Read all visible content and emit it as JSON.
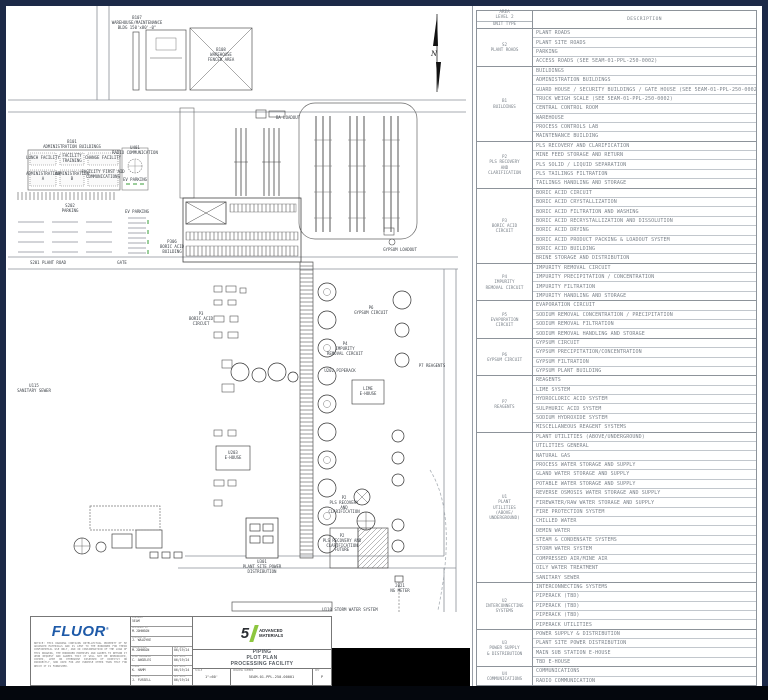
{
  "colors": {
    "frame_navy": "#1c2947",
    "fluor_blue": "#1e5aa8",
    "brand_green": "#8dc63f",
    "line_gray": "#666666"
  },
  "table": {
    "header": {
      "area": "AREA\nLEVEL 2",
      "unit_type": "UNIT TYPE",
      "description": "DESCRIPTION"
    },
    "groups": [
      {
        "code": "S2",
        "label_lines": [
          "S2",
          "PLANT ROADS"
        ],
        "rows": [
          "PLANT ROADS",
          "PLANT SITE ROADS",
          "PARKING",
          "ACCESS ROADS (SEE 5EAM-01-PPL-250-0002)"
        ]
      },
      {
        "code": "B1",
        "label_lines": [
          "B1",
          "BUILDINGS"
        ],
        "rows": [
          "BUILDINGS",
          "ADMINISTRATION BUILDINGS",
          "GUARD HOUSE / SECURITY BUILDINGS / GATE HOUSE (SEE 5EAM-01-PPL-250-0002)",
          "TRUCK WEIGH SCALE (SEE 5EAM-01-PPL-250-0002)",
          "CENTRAL CONTROL ROOM",
          "WAREHOUSE",
          "PROCESS CONTROLS LAB",
          "MAINTENANCE BUILDING"
        ]
      },
      {
        "code": "P2",
        "label_lines": [
          "P2",
          "PLS RECOVERY",
          "AND",
          "CLARIFICATION"
        ],
        "rows": [
          "PLS RECOVERY AND CLARIFICATION",
          "MINE FEED STORAGE AND RETURN",
          "PLS SOLID / LIQUID SEPARATION",
          "PLS TAILINGS FILTRATION",
          "TAILINGS HANDLING AND STORAGE"
        ]
      },
      {
        "code": "P3",
        "label_lines": [
          "P3",
          "BORIC ACID",
          "CIRCUIT"
        ],
        "rows": [
          "BORIC ACID CIRCUIT",
          "BORIC ACID CRYSTALLIZATION",
          "BORIC ACID FILTRATION AND WASHING",
          "BORIC ACID RECRYSTALLIZATION AND DISSOLUTION",
          "BORIC ACID DRYING",
          "BORIC ACID PRODUCT PACKING & LOADOUT SYSTEM",
          "BORIC ACID BUILDING",
          "BRINE STORAGE AND DISTRIBUTION"
        ]
      },
      {
        "code": "P4",
        "label_lines": [
          "P4",
          "IMPURITY",
          "REMOVAL CIRCUIT"
        ],
        "rows": [
          "IMPURITY REMOVAL CIRCUIT",
          "IMPURITY PRECIPITATION / CONCENTRATION",
          "IMPURITY FILTRATION",
          "IMPURITY HANDLING AND STORAGE"
        ]
      },
      {
        "code": "P5",
        "label_lines": [
          "P5",
          "EVAPORATION",
          "CIRCUIT"
        ],
        "rows": [
          "EVAPORATION CIRCUIT",
          "SODIUM REMOVAL CONCENTRATION / PRECIPITATION",
          "SODIUM REMOVAL FILTRATION",
          "SODIUM REMOVAL HANDLING AND STORAGE"
        ]
      },
      {
        "code": "P6",
        "label_lines": [
          "P6",
          "GYPSUM CIRCUIT"
        ],
        "rows": [
          "GYPSUM CIRCUIT",
          "GYPSUM PRECIPITATION/CONCENTRATION",
          "GYPSUM FILTRATION",
          "GYPSUM PLANT BUILDING"
        ]
      },
      {
        "code": "P7",
        "label_lines": [
          "P7",
          "REAGENTS"
        ],
        "rows": [
          "REAGENTS",
          "LIME SYSTEM",
          "HYDROCLORIC ACID SYSTEM",
          "SULPHURIC ACID SYSTEM",
          "SODIUM HYDROXIDE SYSTEM",
          "MISCELLANEOUS REAGENT SYSTEMS"
        ]
      },
      {
        "code": "U1",
        "label_lines": [
          "U1",
          "PLANT",
          "UTILITIES",
          "(ABOVE/",
          "UNDERGROUND)"
        ],
        "rows": [
          "PLANT UTILITIES (ABOVE/UNDERGROUND)",
          "UTILITIES GENERAL",
          "NATURAL GAS",
          "PROCESS WATER STORAGE AND SUPPLY",
          "GLAND WATER STORAGE AND SUPPLY",
          "POTABLE WATER STORAGE AND SUPPLY",
          "REVERSE OSMOSIS WATER STORAGE AND SUPPLY",
          "FIREWATER/RAW WATER STORAGE AND SUPPLY",
          "FIRE PROTECTION SYSTEM",
          "CHILLED WATER",
          "DEMIN WATER",
          "STEAM & CONDENSATE SYSTEMS",
          "STORM WATER SYSTEM",
          "COMPRESSED AIR/MINE AIR",
          "OILY WATER TREATMENT",
          "SANITARY SEWER"
        ]
      },
      {
        "code": "U2",
        "label_lines": [
          "U2",
          "INTERCONNECTING",
          "SYSTEMS"
        ],
        "rows": [
          "INTERCONNECTING SYSTEMS",
          "PIPERACK (TBD)",
          "PIPERACK (TBD)",
          "PIPERACK (TBD)",
          "PIPERACK UTILITIES"
        ]
      },
      {
        "code": "U3",
        "label_lines": [
          "U3",
          "POWER SUPPLY",
          "& DISTRIBUTION"
        ],
        "rows": [
          "POWER SUPPLY & DISTRIBUTION",
          "PLANT SITE POWER DISTRIBUTION",
          "MAIN SUB STATION E-HOUSE",
          "TBD E-HOUSE"
        ]
      },
      {
        "code": "U4",
        "label_lines": [
          "U4",
          "COMMUNICATIONS"
        ],
        "rows": [
          "COMMUNICATIONS",
          "RADIO COMMUNICATION"
        ]
      }
    ]
  },
  "plot": {
    "north_label": "N",
    "labels": [
      {
        "name": "label-b107",
        "x": 137,
        "y": 16,
        "text": "B107\nWAREHOUSE/MAINTENANCE\nBLDG 150'x80'-0\""
      },
      {
        "name": "label-b108",
        "x": 221,
        "y": 48,
        "text": "B108\nWAREHOUSE\nFENCED AREA"
      },
      {
        "name": "label-b101",
        "x": 72,
        "y": 140,
        "text": "B101\nADMINISTRATION BUILDINGS"
      },
      {
        "name": "label-lunch",
        "x": 43,
        "y": 156,
        "text": "LUNCH FACILITY"
      },
      {
        "name": "label-training",
        "x": 72,
        "y": 154,
        "text": "FACILITY\nTRAINING"
      },
      {
        "name": "label-change",
        "x": 103,
        "y": 156,
        "text": "CHANGE FACILITY"
      },
      {
        "name": "label-admin-a",
        "x": 43,
        "y": 172,
        "text": "ADMINISTRATION\nA"
      },
      {
        "name": "label-admin-b",
        "x": 72,
        "y": 172,
        "text": "ADMINISTRATION\nB"
      },
      {
        "name": "label-firstaid",
        "x": 103,
        "y": 170,
        "text": "FACILITY FIRST AID\nCOMMUNICATIONS"
      },
      {
        "name": "label-u401",
        "x": 135,
        "y": 146,
        "text": "U401\nRADIO COMMUNICATION"
      },
      {
        "name": "label-ev-parking-1",
        "x": 135,
        "y": 178,
        "text": "EV PARKING"
      },
      {
        "name": "label-s202",
        "x": 70,
        "y": 204,
        "text": "S202\nPARKING"
      },
      {
        "name": "label-ev-parking-2",
        "x": 137,
        "y": 210,
        "text": "EV PARKING"
      },
      {
        "name": "label-s201",
        "x": 48,
        "y": 261,
        "text": "S201 PLANT ROAD"
      },
      {
        "name": "label-gate",
        "x": 122,
        "y": 261,
        "text": "GATE"
      },
      {
        "name": "label-ba-loadout",
        "x": 288,
        "y": 116,
        "text": "BA LOADOUT"
      },
      {
        "name": "label-p306",
        "x": 172,
        "y": 240,
        "text": "P306\nBORIC ACID\nBUILDING"
      },
      {
        "name": "label-p3-circuit",
        "x": 201,
        "y": 312,
        "text": "P3\nBORIC ACID\nCIRCUIT"
      },
      {
        "name": "label-gypsum-loadout",
        "x": 400,
        "y": 248,
        "text": "GYPSUM LOADOUT"
      },
      {
        "name": "label-p6",
        "x": 371,
        "y": 306,
        "text": "P6\nGYPSUM CIRCUIT"
      },
      {
        "name": "label-p4",
        "x": 345,
        "y": 342,
        "text": "P4\nIMPURITY\nREMOVAL CIRCUIT"
      },
      {
        "name": "label-u202",
        "x": 340,
        "y": 369,
        "text": "U202 PIPERACK"
      },
      {
        "name": "label-ehouse-lime",
        "x": 368,
        "y": 387,
        "text": "LIME\nE-HOUSE"
      },
      {
        "name": "label-u203",
        "x": 233,
        "y": 451,
        "text": "U203\nE-HOUSE"
      },
      {
        "name": "label-p7",
        "x": 432,
        "y": 364,
        "text": "P7 REAGENTS"
      },
      {
        "name": "label-p2",
        "x": 344,
        "y": 496,
        "text": "P2\nPLS RECOVERY\nAND\nCLARIFICATION"
      },
      {
        "name": "label-p2-future",
        "x": 342,
        "y": 534,
        "text": "P2\nPLS RECOVERY AND\nCLARIFICATION\nFUTURE"
      },
      {
        "name": "label-u301",
        "x": 262,
        "y": 560,
        "text": "U301\nPLANT SITE POWER\nDISTRIBUTION"
      },
      {
        "name": "label-ng-meter",
        "x": 400,
        "y": 584,
        "text": "2021\nNG METER"
      },
      {
        "name": "label-storm",
        "x": 350,
        "y": 608,
        "text": "U110 STORM WATER SYSTEM"
      },
      {
        "name": "label-sanitary",
        "x": 34,
        "y": 384,
        "text": "U115\nSANITARY SEWER"
      }
    ]
  },
  "titleblock": {
    "fluor_logo": "FLUOR",
    "fluor_reg": "®",
    "notice": "NOTICE: THIS DRAWING CONTAINS INTELLECTUAL PROPERTY OF 5E ADVANCED MATERIALS AND IS LENT TO THE BORROWER FOR THEIR CONFIDENTIAL USE ONLY, AND IN CONSIDERATION OF THE LOAN OF THIS DRAWING, THE BORROWER PROMISES AND AGREES TO RETURN IT UPON REQUEST AND AGREES THAT IT WILL NOT BE REPRODUCED, COPIED, LENT OR OTHERWISE DISPOSED OF DIRECTLY OR INDIRECTLY, NOR USED FOR ANY PURPOSE OTHER THAN THAT FOR WHICH IT IS FURNISHED.",
    "contract_rows": [
      {
        "label": "CONTRACT",
        "value": "5EAM"
      },
      {
        "label": "DESIGNED BY",
        "value": "M.JOHNSON"
      },
      {
        "label": "CHECKED BY",
        "value": "J. WALDYKE"
      },
      {
        "label": "SUPERVISOR",
        "value": "M.JOHNSON",
        "date_label": "APP DATE",
        "date": "06/19/24"
      },
      {
        "label": "LEAD ENGINEER",
        "value": "C. ANGELES",
        "date_label": "APP DATE",
        "date": "06/19/24"
      },
      {
        "label": "FLUOR",
        "value": "K. HAMM",
        "date_label": "APP DATE",
        "date": "06/19/24"
      },
      {
        "label": "CLIENT",
        "value": "J. FUSSELL",
        "date_label": "APP DATE",
        "date": "06/19/24"
      }
    ],
    "brand": {
      "five": "5",
      "name_line1": "ADVANCED",
      "name_line2": "MATERIALS"
    },
    "title_lines": [
      "PIPING",
      "PLOT PLAN",
      "PROCESSING FACILITY"
    ],
    "scale_label": "SCALE",
    "scale": "1\"=60'",
    "dwg_label": "DRAWING NUMBER",
    "dwg_number": "5EAM-01-PPL-250-00001",
    "rev_label": "REV",
    "rev": "P"
  }
}
